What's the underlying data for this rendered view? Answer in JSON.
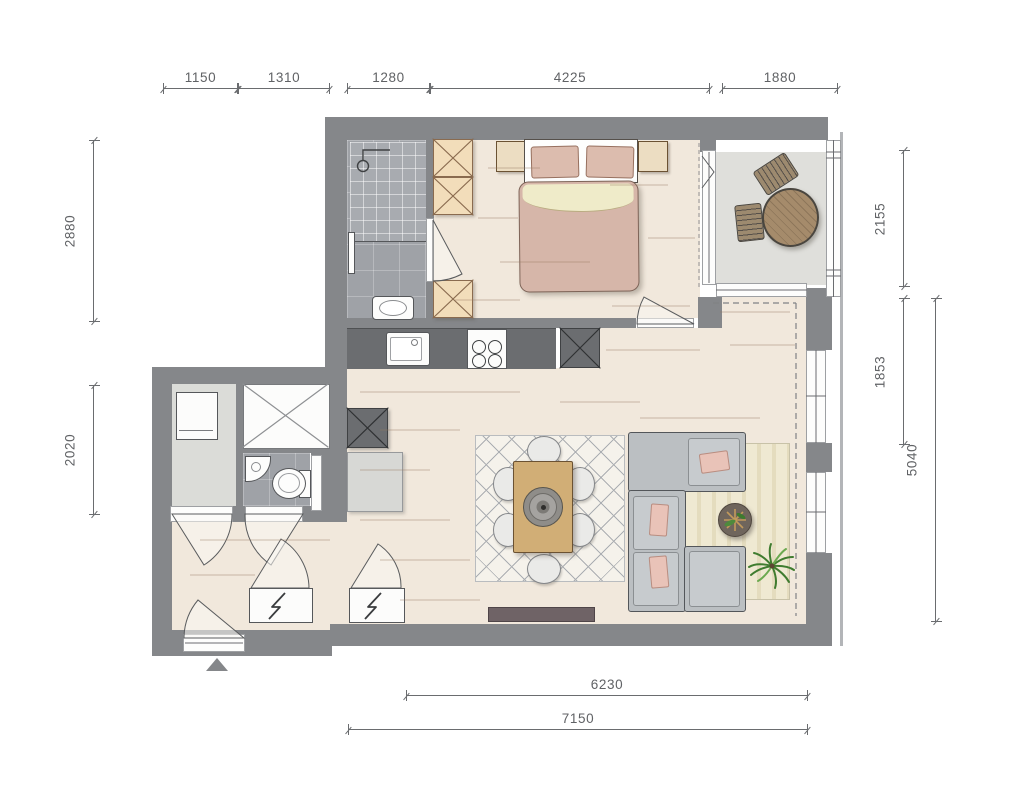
{
  "drawing": {
    "type": "apartment-floor-plan",
    "rooms": [
      "bathroom",
      "bedroom",
      "balcony",
      "kitchen",
      "living-dining",
      "hall",
      "toilet",
      "storage"
    ]
  },
  "dimensions": {
    "top": [
      {
        "value": "1150"
      },
      {
        "value": "1310"
      },
      {
        "value": "1280"
      },
      {
        "value": "4225"
      },
      {
        "value": "1880"
      }
    ],
    "left": [
      {
        "value": "2880"
      },
      {
        "value": "2020"
      }
    ],
    "right": [
      {
        "value": "2155"
      },
      {
        "value": "1853"
      },
      {
        "value": "5040"
      }
    ],
    "bottom": [
      {
        "value": "6230"
      },
      {
        "value": "7150"
      }
    ]
  },
  "colors": {
    "wall": "#85878A",
    "counter": "#6B6D70",
    "wood_floor": "#F1E8DC",
    "tile_floor": "#9FA2A7",
    "shower_tile": "#A8ABB0",
    "balcony_floor": "#DFDFDB",
    "storage_floor": "#DBDCD8",
    "cabinet_tan": "#F2DDBA",
    "cabinet_x_line": "#8A6B4F",
    "bed_blanket": "#D6B6A9",
    "bed_fold": "#EFEBC9",
    "sofa": "#BBBFC2",
    "cushion_pink": "#E9C3B8",
    "rug_cream": "#F5F2EB",
    "rug_stripe": "#E8E1C4",
    "dining_table": "#D1AE76",
    "balcony_table": "#A58B6B",
    "plant": "#3F7C2F",
    "dimension_line": "#6A6C6F",
    "dimension_text": "#606265"
  }
}
